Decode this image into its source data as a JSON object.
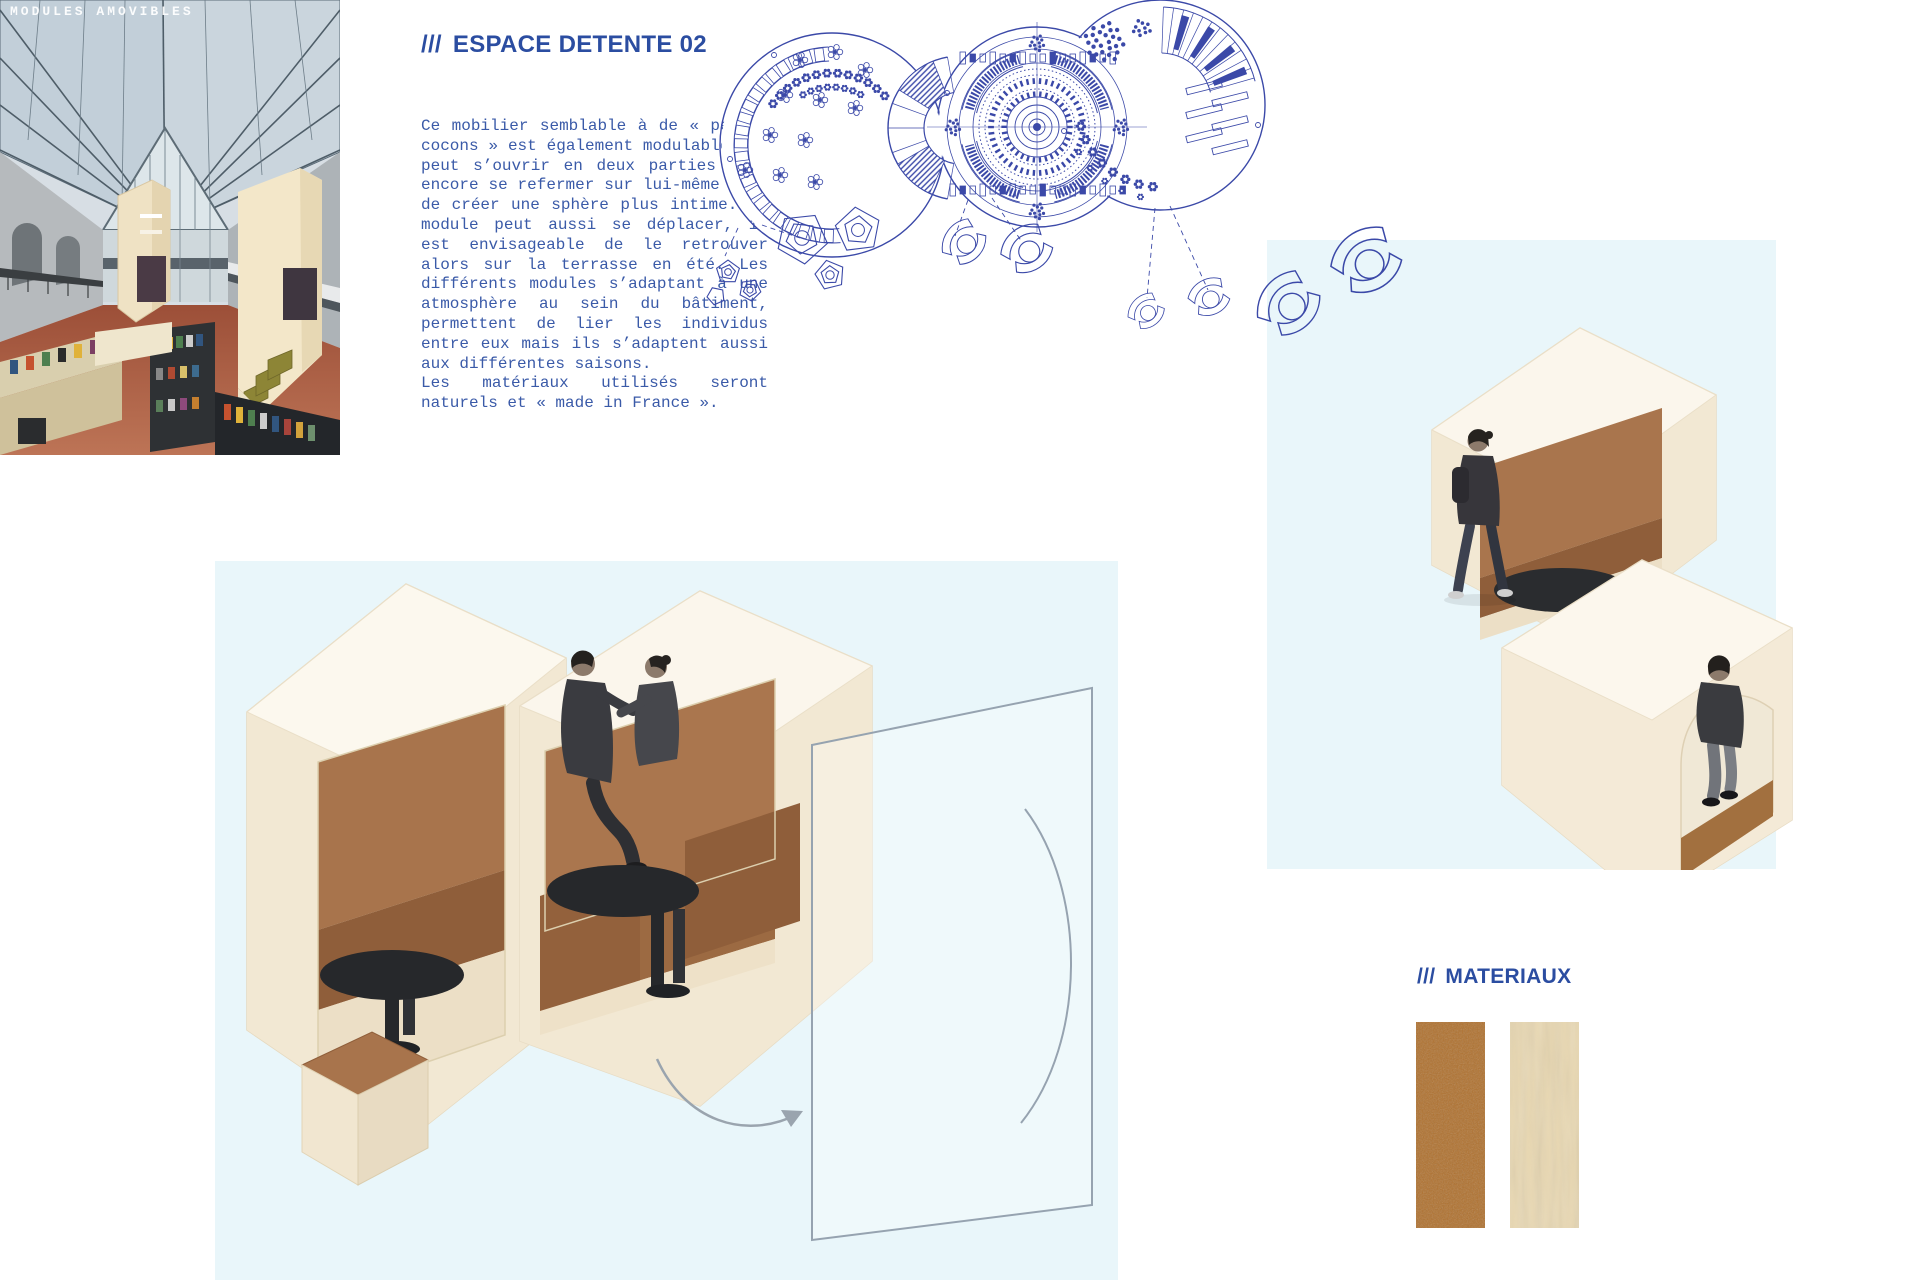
{
  "header": {
    "photo_label": "MODULES AMOVIBLES"
  },
  "section": {
    "slashes": "///",
    "title": "ESPACE DETENTE 02"
  },
  "body": {
    "paragraphs": [
      {
        "lines": [
          "Ce mobilier semblable à de « petits",
          "cocons » est également modulable. Il",
          "peut s’ouvrir en deux parties mais",
          "encore se refermer sur lui-même afin",
          "de créer une sphère plus intime. Ce",
          "module peut aussi se déplacer, il",
          "est envisageable de le retrouver",
          "alors sur la terrasse en été. Les",
          "différents modules s’adaptant à une",
          "atmosphère au sein du bâtiment,",
          "permettent de lier les individus",
          "entre eux mais ils s’adaptent aussi",
          "aux différentes saisons."
        ]
      },
      {
        "lines": [
          "Les matériaux utilisés seront",
          "naturels et « made in France »."
        ]
      }
    ]
  },
  "materials": {
    "slashes": "///",
    "title": "MATERIAUX",
    "swatches": [
      {
        "label": "leather",
        "color": "#b0712e"
      },
      {
        "label": "plywood",
        "color": "#e9d8b2"
      }
    ]
  },
  "colors": {
    "accent_blue": "#2b4da1",
    "text_blue": "#3a5aa8",
    "blueprint_blue": "#3b49a8",
    "pale_blue_panel": "#e9f6fa",
    "wood_shell": "#f6eedd",
    "leather_brown": "#a8744c",
    "table_dark": "#26282b"
  }
}
